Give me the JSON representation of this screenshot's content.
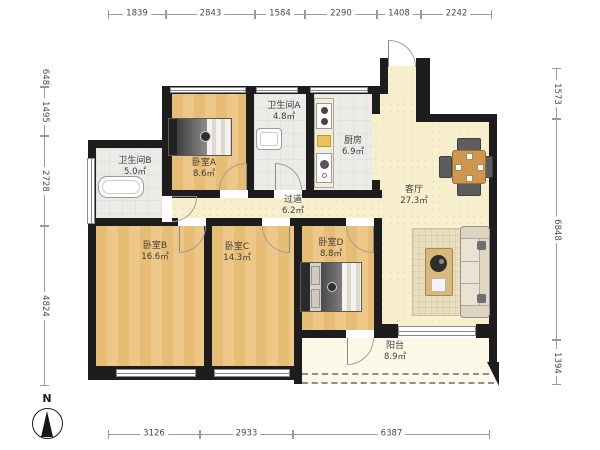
{
  "rooms": {
    "bathroom_b": {
      "name": "卫生间B",
      "area": "5.0㎡"
    },
    "bedroom_a": {
      "name": "卧室A",
      "area": "8.6㎡"
    },
    "bathroom_a": {
      "name": "卫生间A",
      "area": "4.8㎡"
    },
    "kitchen": {
      "name": "厨房",
      "area": "6.9㎡"
    },
    "hallway": {
      "name": "过道",
      "area": "6.2㎡"
    },
    "living_room": {
      "name": "客厅",
      "area": "27.3㎡"
    },
    "bedroom_b": {
      "name": "卧室B",
      "area": "16.6㎡"
    },
    "bedroom_c": {
      "name": "卧室C",
      "area": "14.3㎡"
    },
    "bedroom_d": {
      "name": "卧室D",
      "area": "8.8㎡"
    },
    "balcony": {
      "name": "阳台",
      "area": "8.9㎡"
    }
  },
  "dimensions": {
    "top": [
      "1839",
      "2843",
      "1584",
      "2290",
      "1408",
      "2242"
    ],
    "bottom": [
      "3126",
      "2933",
      "6387"
    ],
    "left": [
      "648",
      "1495",
      "2728",
      "4824"
    ],
    "right": [
      "1573",
      "6848",
      "1394"
    ]
  },
  "compass": {
    "label": "N"
  },
  "colors": {
    "wall": "#1d1d1d",
    "wood_floor": "#e8c07a",
    "tile_floor": "#ecebe8",
    "living_floor": "#f7efcd",
    "balcony_floor": "#fcf9e8"
  }
}
